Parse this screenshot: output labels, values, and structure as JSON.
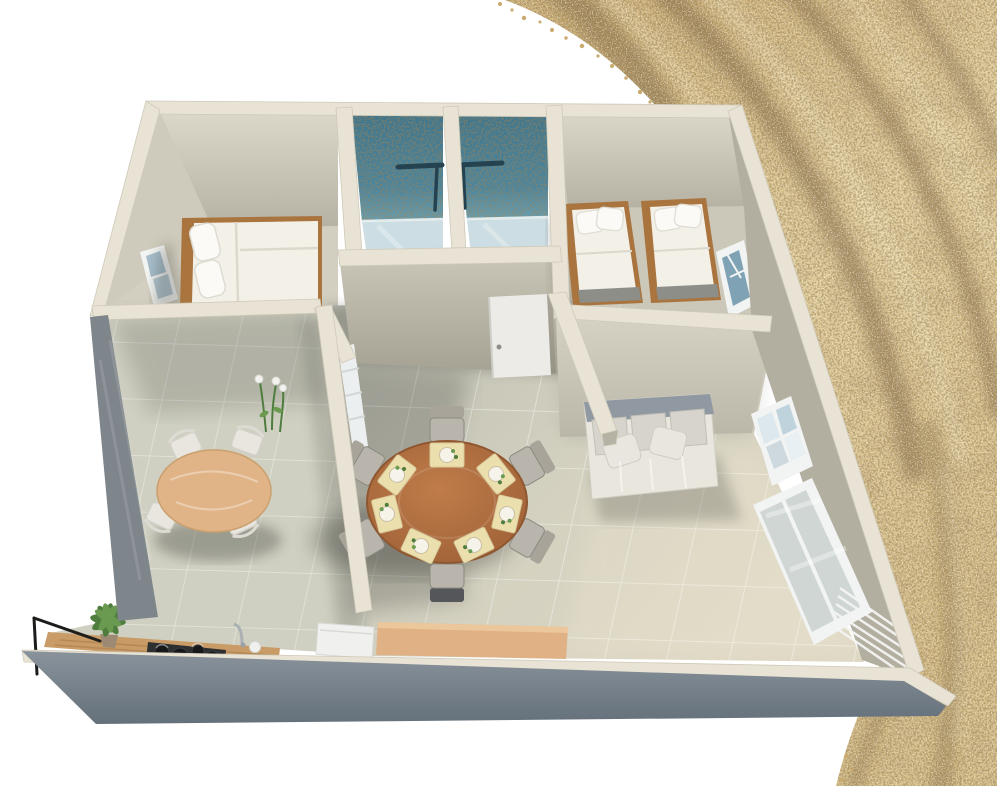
{
  "scene": {
    "label": "3D rendered floor plan of a two-bedroom apartment beside golden sand dunes",
    "rooms": [
      {
        "name": "bedroom-1",
        "furniture": [
          "double-bed",
          "window"
        ]
      },
      {
        "name": "shower-room-1",
        "furniture": [
          "teal-tiled-shower",
          "glass-screen"
        ]
      },
      {
        "name": "shower-room-2",
        "furniture": [
          "teal-tiled-shower",
          "glass-screen",
          "white-door"
        ]
      },
      {
        "name": "bedroom-2",
        "furniture": [
          "twin-bed-left",
          "twin-bed-right",
          "window"
        ]
      },
      {
        "name": "breakfast-nook",
        "furniture": [
          "round-wood-table",
          "four-white-chairs",
          "flowers"
        ]
      },
      {
        "name": "kitchen",
        "furniture": [
          "wood-counter",
          "plant",
          "cooktop",
          "faucet",
          "appliance",
          "tan-island"
        ]
      },
      {
        "name": "dining-area",
        "furniture": [
          "large-round-table",
          "six-chairs",
          "seven-placemats",
          "radiator-panel"
        ]
      },
      {
        "name": "living-area",
        "furniture": [
          "sofa",
          "upper-window",
          "lower-window",
          "blinds"
        ]
      }
    ],
    "background": "sand-dune-photo-band"
  },
  "colors": {
    "background": "#ffffff",
    "sand_base": "#d9bf8a",
    "sand_mid": "#c9a96e",
    "sand_dark": "#5f4524",
    "sand_light": "#f4e7c1",
    "wall_cap": "#e8e3d4",
    "wall_face": "#c7c3b4",
    "wall_face_dark": "#a9a598",
    "wall_face_light": "#d9d5c6",
    "wall_exterior": "#76808a",
    "wall_side_gray": "#7e858b",
    "floor_light": "#ddd8c6",
    "floor_mid": "#cfd0c1",
    "teal_tile": "#45819b",
    "teal_dark": "#24424f",
    "glass_blue": "#c3d8de",
    "window_glass": "#9db8c6",
    "window_frame": "#f2f4f3",
    "wood_bed": "#a9743e",
    "wood_table": "#b06f41",
    "wood_table_light": "#e0b487",
    "counter_wood": "#c99c67",
    "island_tan": "#dfb184",
    "bedding": "#f3f0e8",
    "pillow": "#fbfaf6",
    "sofa_body": "#e9e6dd",
    "sofa_back": "#9099a2",
    "sofa_cushion": "#d6d4cd",
    "chair_gray": "#b9b5ac",
    "chair_white": "#e8e6df",
    "placemat": "#ecdfae",
    "plate": "#f6f3ea",
    "plant_green": "#4e7d3e",
    "plant_light": "#6a9a50",
    "door_white": "#ecebe7",
    "appliance_white": "#f0f1ee",
    "cooktop_black": "#2e2f31",
    "railing_black": "#1d1d1b",
    "shadow": "#3c3e38"
  }
}
